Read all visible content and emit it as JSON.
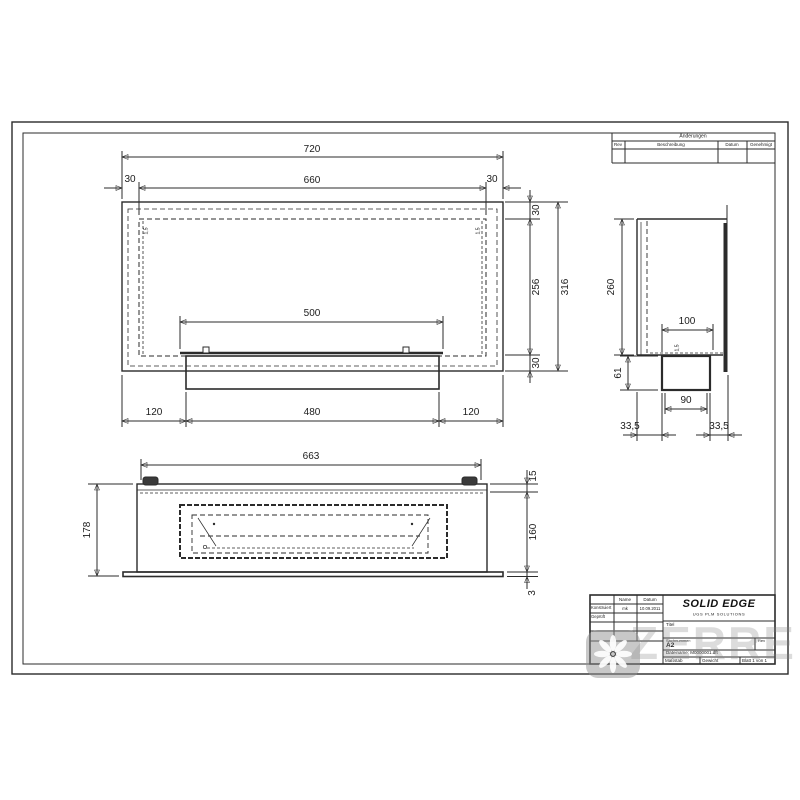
{
  "watermark": {
    "text": "ZERRE"
  },
  "revisions": {
    "title": "Änderungen",
    "col_rev": "Rev",
    "col_desc": "Beschreibung",
    "col_date": "Datum",
    "col_appr": "Genehmigt"
  },
  "titleblock": {
    "col_name": "Name",
    "col_date": "Datum",
    "row_drawn_label": "Konstruiert",
    "row_drawn_name": "mk",
    "row_drawn_date": "10.09.2011",
    "row_checked_label": "Geprüft",
    "logo": "SOLID EDGE",
    "logo_sub": "UGS PLM SOLUTIONS",
    "title_label": "Titel",
    "partnumber_label": "Sachnummer:",
    "sheet_size": "A2",
    "rev_label": "Rev",
    "filename": "Dateiname: M0000001.dft",
    "scale_label": "Maßstab",
    "weight_label": "Gewicht",
    "sheet_label": "Blatt 1 von 1"
  },
  "front_view": {
    "total_width": "720",
    "inner_width": "660",
    "offset_left": "30",
    "offset_right": "30",
    "opening_width": "500",
    "offset_top": "30",
    "inner_height": "256",
    "offset_bottom": "30",
    "total_height": "316",
    "foot_left": "120",
    "tray_width": "480",
    "foot_right": "120",
    "wall_left": "1,5",
    "wall_right": "1,5"
  },
  "side_view": {
    "height": "260",
    "box_width": "100",
    "box_height": "61",
    "box_inner": "90",
    "gap_left": "33,5",
    "gap_right": "33,5",
    "wall": "1,5"
  },
  "bottom_view": {
    "width": "663",
    "lip": "15",
    "inner_height": "160",
    "base": "3",
    "height": "178"
  }
}
